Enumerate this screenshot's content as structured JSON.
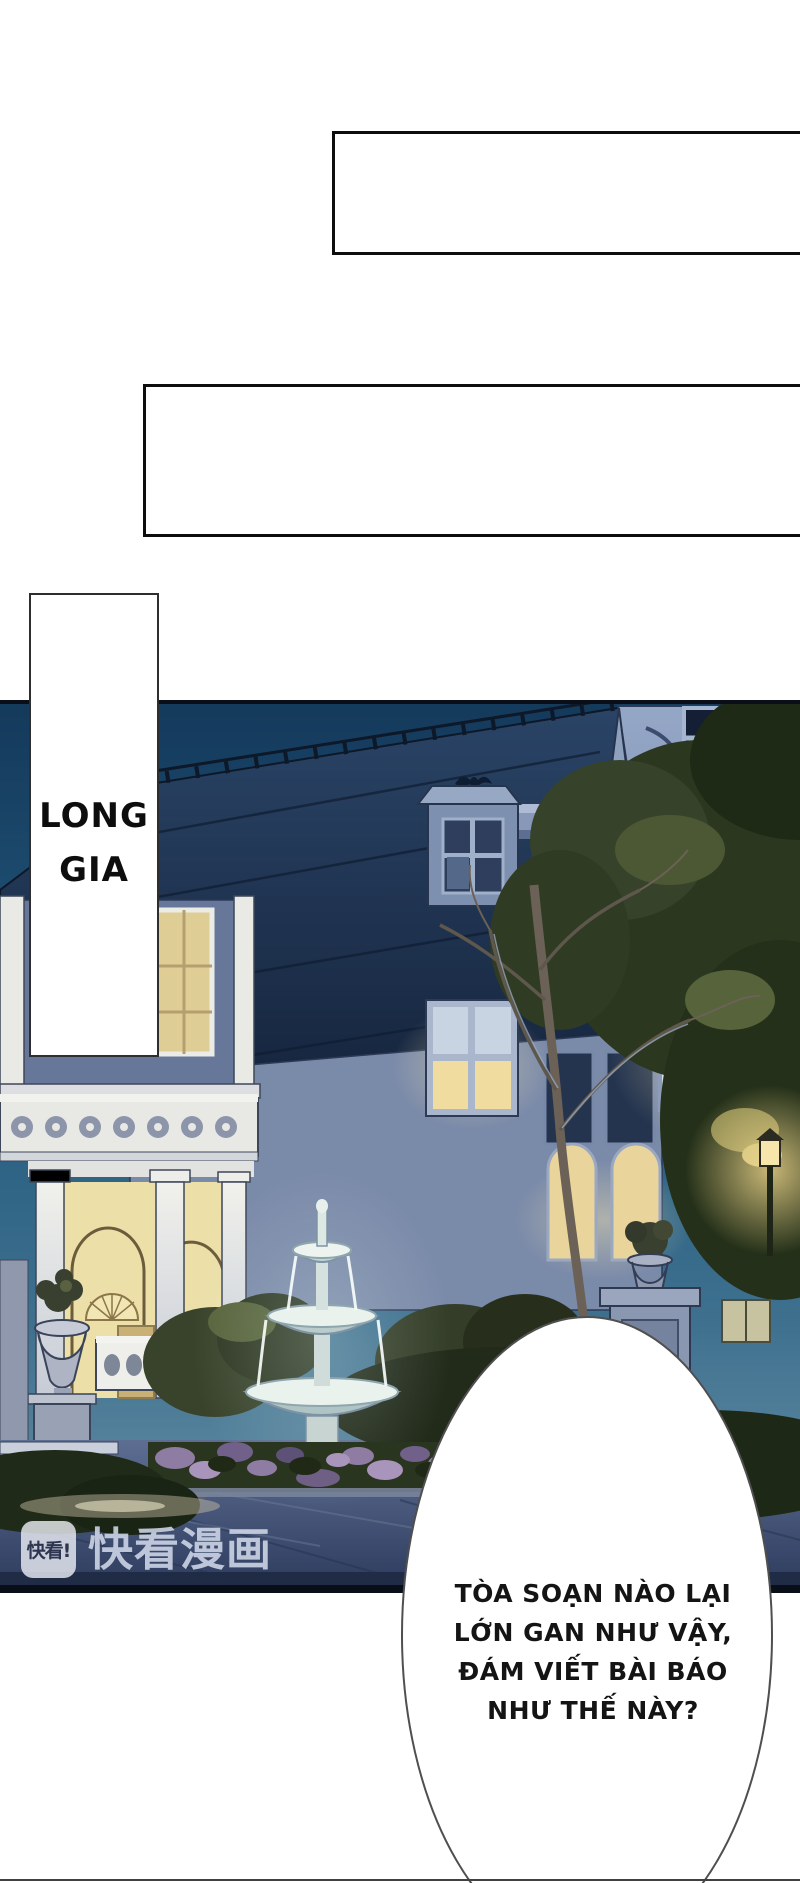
{
  "page": {
    "bg": "#ffffff"
  },
  "caption_boxes": [
    {
      "id": "caption-box-1",
      "text": ""
    },
    {
      "id": "caption-box-2",
      "text": ""
    }
  ],
  "panel_label": {
    "lines": [
      "LONG",
      "GIA"
    ]
  },
  "speech_bubble": {
    "lines": [
      "TÒA SOẠN NÀO LẠI",
      "LỚN GAN NHƯ VẬY,",
      "ĐÁM VIẾT BÀI BÁO",
      "NHƯ THẾ NÀY?"
    ]
  },
  "watermark": {
    "icon_text": "快看!",
    "brand_text": "快看漫画"
  },
  "colors": {
    "page-bg": "#ffffff",
    "ink": "#0d0d0d",
    "text": "#141414",
    "bubble-outline": "#4f4f4f",
    "watermark-text": "rgba(208,215,232,0.88)",
    "sky-top": "#14395b",
    "sky-low": "#6e95aa",
    "roof-dark": "#14223a",
    "wall-light": "#95a7c6",
    "wall-shadow": "#6c7c9e",
    "window-dark": "#141f35",
    "window-frame": "#a6b5d0",
    "glow-warm": "#f3e0a2",
    "interior-warm": "#ecdfa8",
    "porch-white": "#e9e9e6",
    "foliage-dark": "#26331d",
    "fountain-light": "#eaf2ee",
    "flower-purple": "#8f7ca3",
    "pave-top": "#5e6e92",
    "pave-bottom": "#2c3b5c",
    "lamp": "#f6e6ac"
  }
}
